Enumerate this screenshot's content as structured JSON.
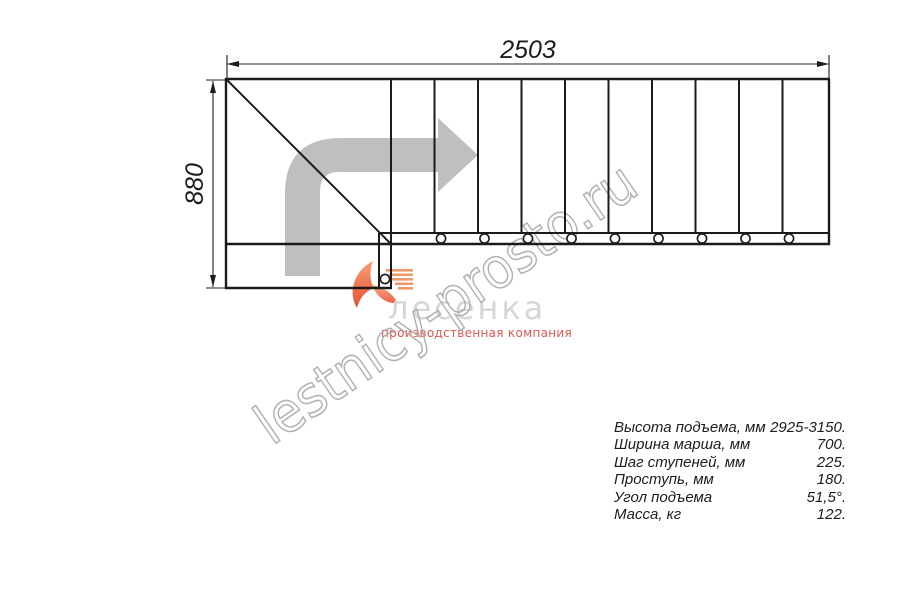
{
  "page": {
    "background": "#ffffff"
  },
  "drawing": {
    "dimension_top": "2503",
    "dimension_left": "880",
    "treads_shown": 10,
    "line_color": "#1b1b1b",
    "direction_arrow_color": "#bfbfbf"
  },
  "watermark": {
    "text": "lestnicy-prosto.ru",
    "color": "#b0b0b0"
  },
  "logo": {
    "name": "лесенка",
    "subtitle": "производственная компания",
    "name_color": "#d6d6d6",
    "subtitle_color": "#e2574d",
    "swoosh_color_top": "#f6a176",
    "swoosh_color_bottom": "#e94e2f",
    "steps_icon_color": "#ed9a68"
  },
  "specs": {
    "rows": [
      {
        "label": "Высота подъема, мм",
        "value": "2925-3150."
      },
      {
        "label": "Ширина марша, мм",
        "value": "700."
      },
      {
        "label": "Шаг ступеней, мм",
        "value": "225."
      },
      {
        "label": "Проступь, мм",
        "value": "180."
      },
      {
        "label": "Угол подъема",
        "value": "51,5°."
      },
      {
        "label": "Масса, кг",
        "value": "122."
      }
    ]
  }
}
